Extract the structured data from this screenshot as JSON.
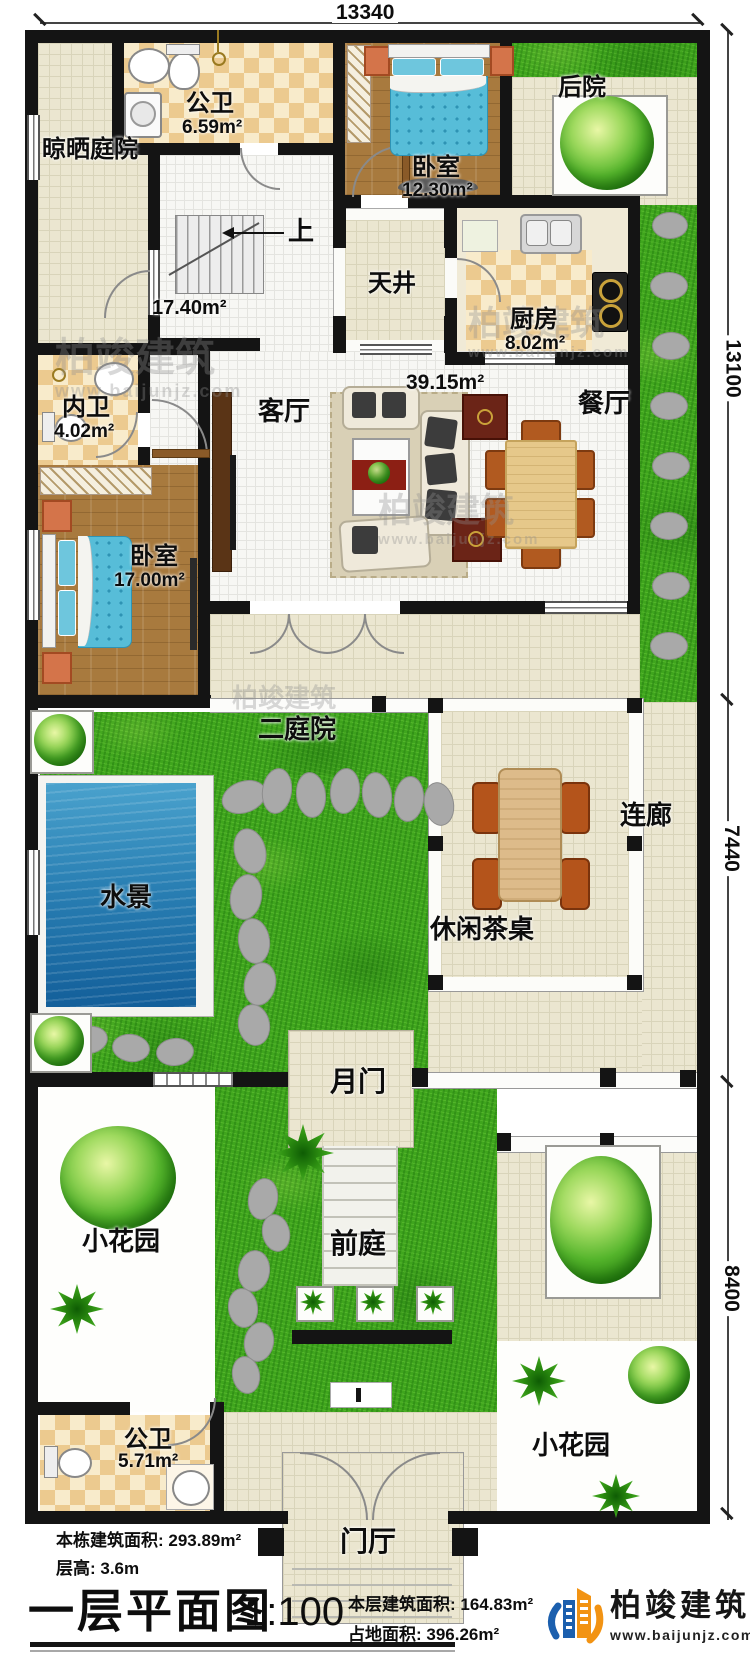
{
  "dimensions": {
    "top": "13340",
    "right_top": "13100",
    "right_middle": "7440",
    "right_bottom": "8400"
  },
  "rooms": {
    "drying_yard": {
      "label": "晾晒庭院"
    },
    "public_bath_top": {
      "label": "公卫",
      "area": "6.59m²"
    },
    "bedroom_top": {
      "label": "卧室",
      "area": "12.30m²"
    },
    "backyard": {
      "label": "后院"
    },
    "stairs": {
      "label": "上"
    },
    "stair_hall": {
      "area": "17.40m²"
    },
    "skywell": {
      "label": "天井"
    },
    "kitchen": {
      "label": "厨房",
      "area": "8.02m²"
    },
    "ensuite_bath": {
      "label": "内卫",
      "area": "4.02m²"
    },
    "bedroom_left": {
      "label": "卧室",
      "area": "17.00m²"
    },
    "living_room": {
      "label": "客厅",
      "area": "39.15m²"
    },
    "dining_room": {
      "label": "餐厅"
    },
    "second_courtyard": {
      "label": "二庭院"
    },
    "water_feature": {
      "label": "水景"
    },
    "tea_table": {
      "label": "休闲茶桌"
    },
    "corridor": {
      "label": "连廊"
    },
    "moon_gate": {
      "label": "月门"
    },
    "garden_left": {
      "label": "小花园"
    },
    "front_court": {
      "label": "前庭"
    },
    "garden_right": {
      "label": "小花园"
    },
    "public_bath_bottom": {
      "label": "公卫",
      "area": "5.71m²"
    },
    "foyer": {
      "label": "门厅"
    }
  },
  "title_block": {
    "building_total_area": "本栋建筑面积: 293.89m²",
    "floor_height": "层高: 3.6m",
    "plan_title": "一层平面图",
    "scale": "1:100",
    "floor_area": "本层建筑面积: 164.83m²",
    "land_area": "占地面积: 396.26m²"
  },
  "brand": {
    "company": "柏竣建筑",
    "website": "www.baijunjz.com"
  },
  "watermark": {
    "company": "柏竣建筑",
    "website": "www.baijunjz.com"
  }
}
